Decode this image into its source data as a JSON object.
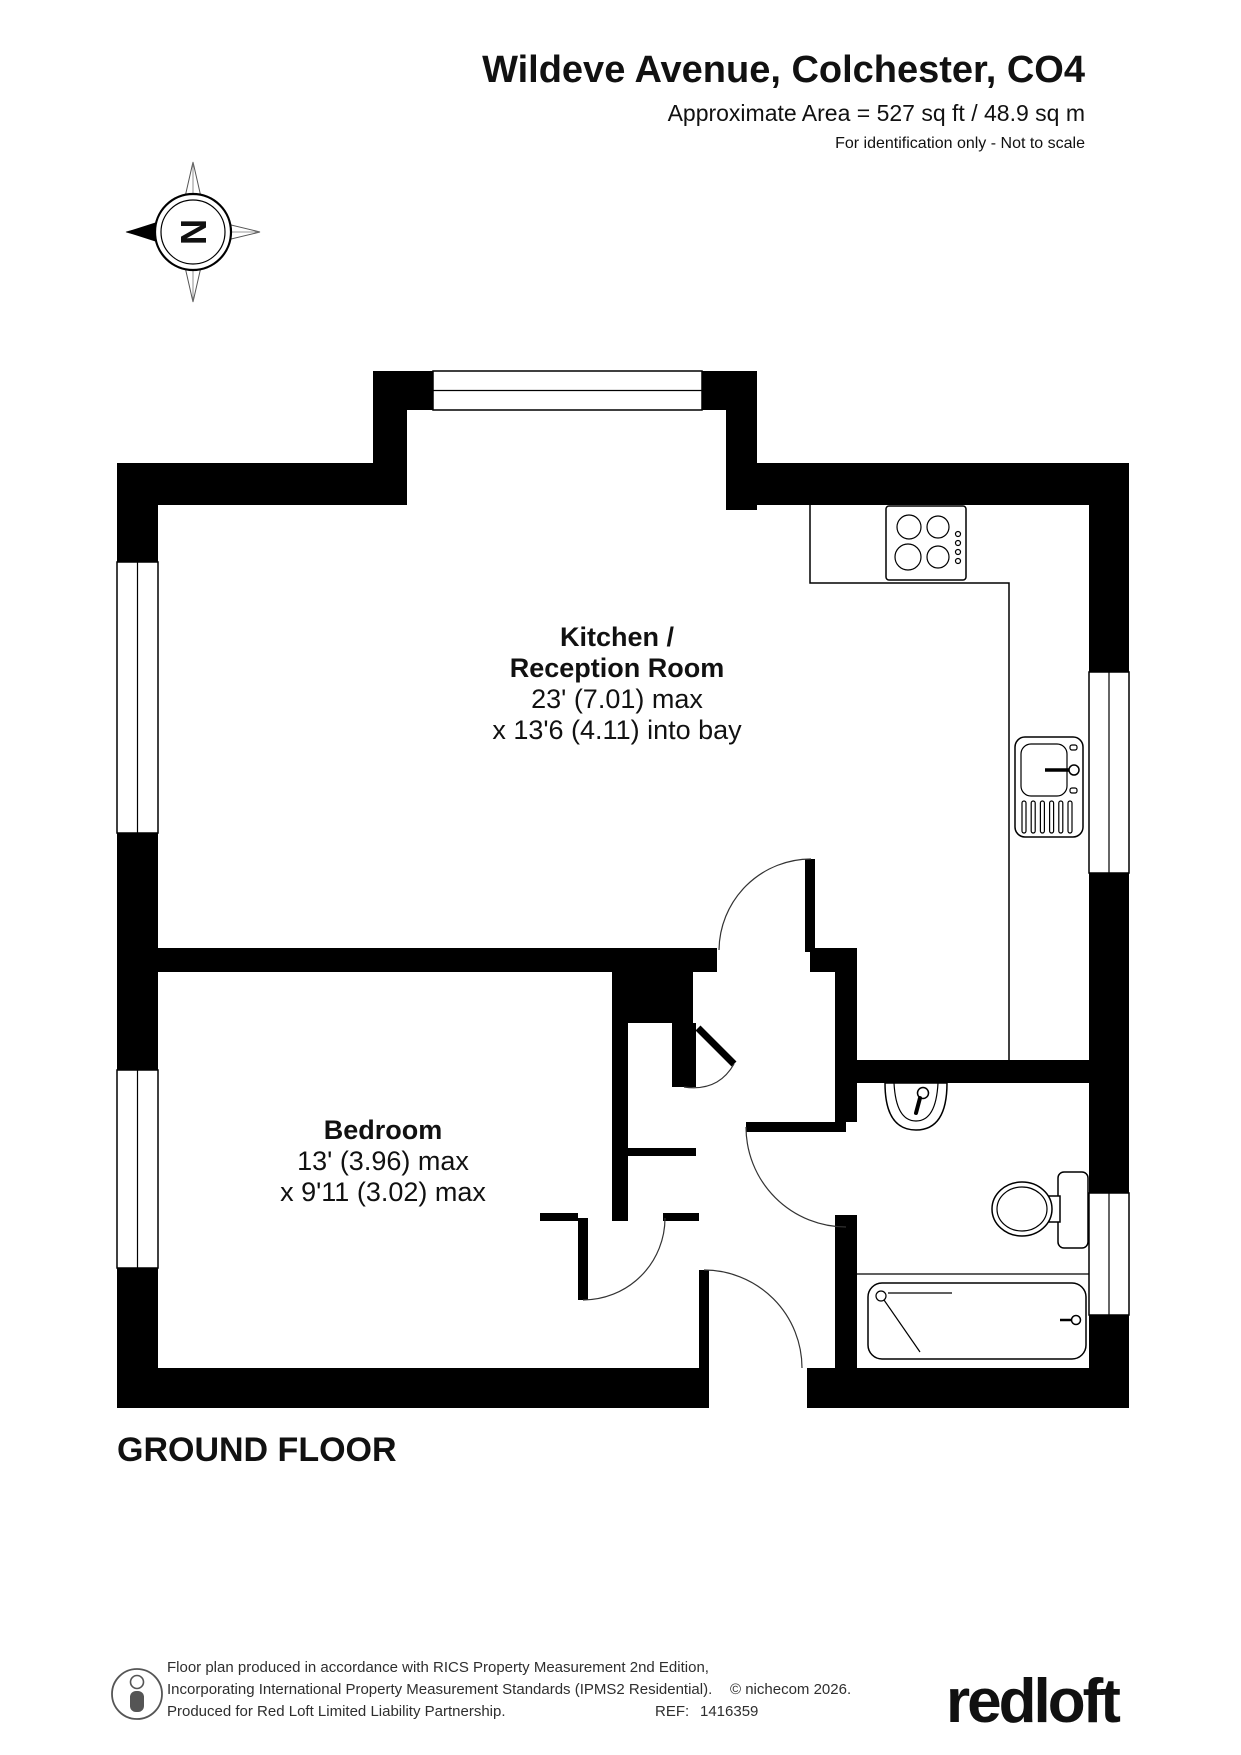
{
  "header": {
    "title": "Wildeve Avenue, Colchester, CO4",
    "area_line": "Approximate Area = 527 sq ft / 48.9 sq m",
    "disclaimer": "For identification only - Not to scale"
  },
  "compass": {
    "north_letter": "N"
  },
  "rooms": {
    "kitchen": {
      "name_line1": "Kitchen /",
      "name_line2": "Reception Room",
      "dims_line1": "23' (7.01) max",
      "dims_line2": "x 13'6 (4.11) into bay"
    },
    "bedroom": {
      "name": "Bedroom",
      "dims_line1": "13' (3.96) max",
      "dims_line2": "x 9'11 (3.02) max"
    }
  },
  "floor_label": "GROUND FLOOR",
  "fixtures": {
    "hob": "hob-icon",
    "sink": "kitchen-sink-icon",
    "basin": "wash-basin-icon",
    "toilet": "toilet-icon",
    "bath": "bath-shower-icon"
  },
  "footer": {
    "line1": "Floor plan produced in accordance with RICS Property Measurement 2nd Edition,",
    "line2": "Incorporating International Property Measurement Standards (IPMS2 Residential).",
    "copyright": "© nichecom 2026.",
    "line3": "Produced for Red Loft Limited Liability Partnership.",
    "ref_label": "REF:",
    "ref_value": "1416359",
    "logo_text": "redloft",
    "logo_gradient_from": "#d8121e",
    "logo_gradient_to": "#9c0e14"
  }
}
